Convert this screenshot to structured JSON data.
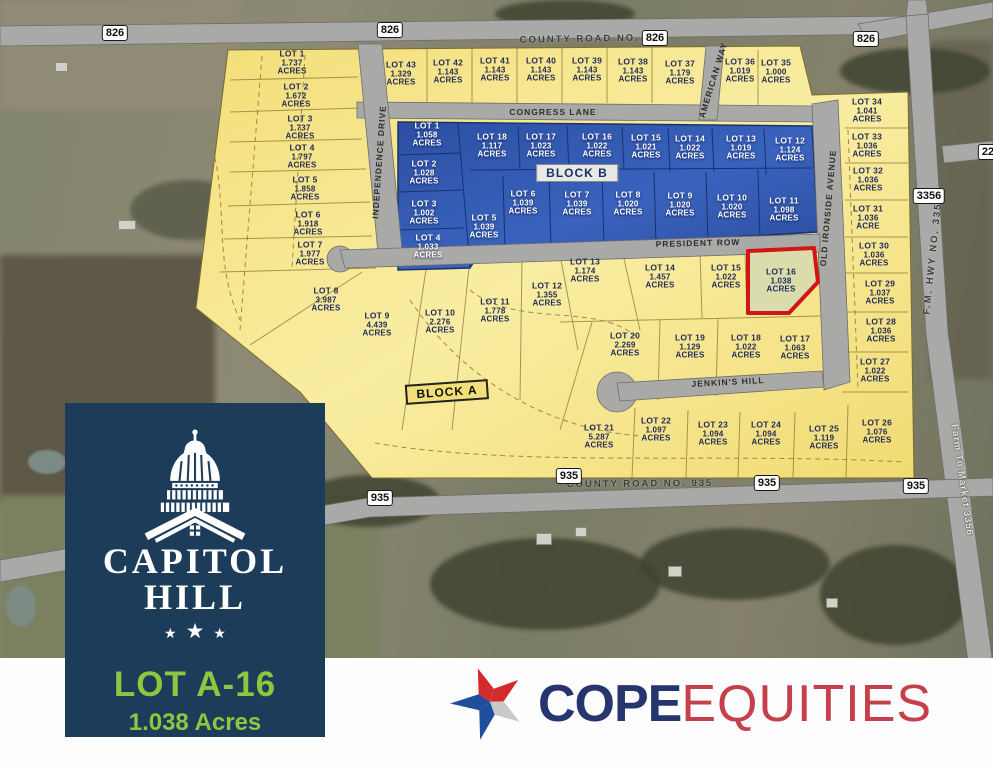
{
  "colors": {
    "lot_yellow": "#f6e488",
    "lot_blue": "#2f55ad",
    "highlight_stroke": "#d01616",
    "panel_navy": "#1d3c59",
    "brand_green": "#8dc63f",
    "cope_navy": "#27356f",
    "cope_red": "#c5404a"
  },
  "branding": {
    "panel": {
      "title_line1": "CAPITOL",
      "title_line2": "HILL",
      "star": "★",
      "lot_id": "LOT A-16",
      "lot_acres": "1.038 Acres"
    },
    "cope": {
      "word1": "COPE",
      "word2": "EQUITIES"
    }
  },
  "map": {
    "blocks": [
      {
        "text": "BLOCK B",
        "x": 577,
        "y": 173,
        "style": "b",
        "rot": 0
      },
      {
        "text": "BLOCK A",
        "x": 447,
        "y": 392,
        "style": "a",
        "rot": -4
      }
    ],
    "street_labels": [
      {
        "text": "COUNTY ROAD NO. 826",
        "x": 593,
        "y": 39,
        "rot": -1,
        "cls": "county"
      },
      {
        "text": "CONGRESS LANE",
        "x": 553,
        "y": 112,
        "rot": 0,
        "cls": "plat"
      },
      {
        "text": "INDEPENDENCE DRIVE",
        "x": 379,
        "y": 162,
        "rot": -86,
        "cls": "plat"
      },
      {
        "text": "AMERICAN WAY",
        "x": 713,
        "y": 80,
        "rot": -73,
        "cls": "plat"
      },
      {
        "text": "OLD IRONSIDE AVENUE",
        "x": 828,
        "y": 208,
        "rot": -85,
        "cls": "plat"
      },
      {
        "text": "PRESIDENT ROW",
        "x": 698,
        "y": 243,
        "rot": -1.5,
        "cls": "plat"
      },
      {
        "text": "JENKIN'S HILL",
        "x": 728,
        "y": 382,
        "rot": -3,
        "cls": "plat"
      },
      {
        "text": "COUNTY ROAD NO. 935",
        "x": 640,
        "y": 484,
        "rot": -0.5,
        "cls": "county"
      },
      {
        "text": "F.M. HWY NO. 3356",
        "x": 933,
        "y": 255,
        "rot": -84,
        "cls": "county"
      },
      {
        "text": "Farm To Market 3356",
        "x": 962,
        "y": 480,
        "rot": 82,
        "cls": "white"
      }
    ],
    "badges": [
      {
        "text": "826",
        "x": 115,
        "y": 33
      },
      {
        "text": "826",
        "x": 390,
        "y": 30
      },
      {
        "text": "826",
        "x": 655,
        "y": 38
      },
      {
        "text": "826",
        "x": 866,
        "y": 39
      },
      {
        "text": "22",
        "x": 988,
        "y": 152
      },
      {
        "text": "3356",
        "x": 929,
        "y": 196
      },
      {
        "text": "935",
        "x": 380,
        "y": 498
      },
      {
        "text": "935",
        "x": 569,
        "y": 476
      },
      {
        "text": "935",
        "x": 767,
        "y": 483
      },
      {
        "text": "935",
        "x": 916,
        "y": 486
      }
    ],
    "lots": [
      {
        "name": "LOT 1",
        "acres": "1.737",
        "unit": "ACRES",
        "x": 292,
        "y": 63,
        "c": "y"
      },
      {
        "name": "LOT 2",
        "acres": "1.672",
        "unit": "ACRES",
        "x": 296,
        "y": 96,
        "c": "y"
      },
      {
        "name": "LOT 3",
        "acres": "1.737",
        "unit": "ACRES",
        "x": 300,
        "y": 128,
        "c": "y"
      },
      {
        "name": "LOT 4",
        "acres": "1.797",
        "unit": "ACRES",
        "x": 302,
        "y": 157,
        "c": "y"
      },
      {
        "name": "LOT 5",
        "acres": "1.858",
        "unit": "ACRES",
        "x": 305,
        "y": 189,
        "c": "y"
      },
      {
        "name": "LOT 6",
        "acres": "1.918",
        "unit": "ACRES",
        "x": 308,
        "y": 224,
        "c": "y"
      },
      {
        "name": "LOT 7",
        "acres": "1.977",
        "unit": "ACRES",
        "x": 310,
        "y": 254,
        "c": "y"
      },
      {
        "name": "LOT 8",
        "acres": "3.987",
        "unit": "ACRES",
        "x": 326,
        "y": 300,
        "c": "y"
      },
      {
        "name": "LOT 9",
        "acres": "4.439",
        "unit": "ACRES",
        "x": 377,
        "y": 325,
        "c": "y"
      },
      {
        "name": "LOT 10",
        "acres": "2.276",
        "unit": "ACRES",
        "x": 440,
        "y": 322,
        "c": "y"
      },
      {
        "name": "LOT 11",
        "acres": "1.778",
        "unit": "ACRES",
        "x": 495,
        "y": 311,
        "c": "y"
      },
      {
        "name": "LOT 12",
        "acres": "1.355",
        "unit": "ACRES",
        "x": 547,
        "y": 295,
        "c": "y"
      },
      {
        "name": "LOT 13",
        "acres": "1.174",
        "unit": "ACRES",
        "x": 585,
        "y": 271,
        "c": "y"
      },
      {
        "name": "LOT 14",
        "acres": "1.457",
        "unit": "ACRES",
        "x": 660,
        "y": 277,
        "c": "y"
      },
      {
        "name": "LOT 15",
        "acres": "1.022",
        "unit": "ACRES",
        "x": 726,
        "y": 277,
        "c": "y"
      },
      {
        "name": "LOT 16",
        "acres": "1.038",
        "unit": "ACRES",
        "x": 781,
        "y": 281,
        "c": "y",
        "hl": true
      },
      {
        "name": "LOT 17",
        "acres": "1.063",
        "unit": "ACRES",
        "x": 795,
        "y": 348,
        "c": "y"
      },
      {
        "name": "LOT 18",
        "acres": "1.022",
        "unit": "ACRES",
        "x": 746,
        "y": 347,
        "c": "y"
      },
      {
        "name": "LOT 19",
        "acres": "1.129",
        "unit": "ACRES",
        "x": 690,
        "y": 347,
        "c": "y"
      },
      {
        "name": "LOT 20",
        "acres": "2.269",
        "unit": "ACRES",
        "x": 625,
        "y": 345,
        "c": "y"
      },
      {
        "name": "LOT 21",
        "acres": "5.287",
        "unit": "ACRES",
        "x": 599,
        "y": 437,
        "c": "y"
      },
      {
        "name": "LOT 22",
        "acres": "1.097",
        "unit": "ACRES",
        "x": 656,
        "y": 430,
        "c": "y"
      },
      {
        "name": "LOT 23",
        "acres": "1.094",
        "unit": "ACRES",
        "x": 713,
        "y": 434,
        "c": "y"
      },
      {
        "name": "LOT 24",
        "acres": "1.094",
        "unit": "ACRES",
        "x": 766,
        "y": 434,
        "c": "y"
      },
      {
        "name": "LOT 25",
        "acres": "1.119",
        "unit": "ACRES",
        "x": 824,
        "y": 438,
        "c": "y"
      },
      {
        "name": "LOT 26",
        "acres": "1.076",
        "unit": "ACRES",
        "x": 877,
        "y": 432,
        "c": "y"
      },
      {
        "name": "LOT 27",
        "acres": "1.022",
        "unit": "ACRES",
        "x": 875,
        "y": 371,
        "c": "y"
      },
      {
        "name": "LOT 28",
        "acres": "1.036",
        "unit": "ACRES",
        "x": 881,
        "y": 331,
        "c": "y"
      },
      {
        "name": "LOT 29",
        "acres": "1.037",
        "unit": "ACRES",
        "x": 880,
        "y": 293,
        "c": "y"
      },
      {
        "name": "LOT 30",
        "acres": "1.036",
        "unit": "ACRES",
        "x": 874,
        "y": 255,
        "c": "y"
      },
      {
        "name": "LOT 31",
        "acres": "1.036",
        "unit": "ACRE",
        "x": 868,
        "y": 218,
        "c": "y"
      },
      {
        "name": "LOT 32",
        "acres": "1.036",
        "unit": "ACRES",
        "x": 868,
        "y": 180,
        "c": "y"
      },
      {
        "name": "LOT 33",
        "acres": "1.036",
        "unit": "ACRES",
        "x": 867,
        "y": 146,
        "c": "y"
      },
      {
        "name": "LOT 34",
        "acres": "1.041",
        "unit": "ACRES",
        "x": 867,
        "y": 111,
        "c": "y"
      },
      {
        "name": "LOT 35",
        "acres": "1.000",
        "unit": "ACRES",
        "x": 776,
        "y": 72,
        "c": "y"
      },
      {
        "name": "LOT 36",
        "acres": "1.019",
        "unit": "ACRES",
        "x": 740,
        "y": 71,
        "c": "y"
      },
      {
        "name": "LOT 37",
        "acres": "1.179",
        "unit": "ACRES",
        "x": 680,
        "y": 73,
        "c": "y"
      },
      {
        "name": "LOT 38",
        "acres": "1.143",
        "unit": "ACRES",
        "x": 633,
        "y": 71,
        "c": "y"
      },
      {
        "name": "LOT 39",
        "acres": "1.143",
        "unit": "ACRES",
        "x": 587,
        "y": 70,
        "c": "y"
      },
      {
        "name": "LOT 40",
        "acres": "1.143",
        "unit": "ACRES",
        "x": 541,
        "y": 70,
        "c": "y"
      },
      {
        "name": "LOT 41",
        "acres": "1.143",
        "unit": "ACRES",
        "x": 495,
        "y": 70,
        "c": "y"
      },
      {
        "name": "LOT 42",
        "acres": "1.143",
        "unit": "ACRES",
        "x": 448,
        "y": 72,
        "c": "y"
      },
      {
        "name": "LOT 43",
        "acres": "1.329",
        "unit": "ACRES",
        "x": 401,
        "y": 74,
        "c": "y"
      },
      {
        "name": "LOT 1",
        "acres": "1.058",
        "unit": "ACRES",
        "x": 427,
        "y": 135,
        "c": "b"
      },
      {
        "name": "LOT 2",
        "acres": "1.028",
        "unit": "ACRES",
        "x": 424,
        "y": 173,
        "c": "b"
      },
      {
        "name": "LOT 3",
        "acres": "1.002",
        "unit": "ACRES",
        "x": 424,
        "y": 213,
        "c": "b"
      },
      {
        "name": "LOT 4",
        "acres": "1.033",
        "unit": "ACRES",
        "x": 428,
        "y": 247,
        "c": "b"
      },
      {
        "name": "LOT 5",
        "acres": "1.039",
        "unit": "ACRES",
        "x": 484,
        "y": 227,
        "c": "b"
      },
      {
        "name": "LOT 6",
        "acres": "1.039",
        "unit": "ACRES",
        "x": 523,
        "y": 203,
        "c": "b"
      },
      {
        "name": "LOT 7",
        "acres": "1.039",
        "unit": "ACRES",
        "x": 577,
        "y": 204,
        "c": "b"
      },
      {
        "name": "LOT 8",
        "acres": "1.020",
        "unit": "ACRES",
        "x": 628,
        "y": 204,
        "c": "b"
      },
      {
        "name": "LOT 9",
        "acres": "1.020",
        "unit": "ACRES",
        "x": 680,
        "y": 205,
        "c": "b"
      },
      {
        "name": "LOT 10",
        "acres": "1.020",
        "unit": "ACRES",
        "x": 732,
        "y": 207,
        "c": "b"
      },
      {
        "name": "LOT 11",
        "acres": "1.098",
        "unit": "ACRES",
        "x": 784,
        "y": 210,
        "c": "b"
      },
      {
        "name": "LOT 12",
        "acres": "1.124",
        "unit": "ACRES",
        "x": 790,
        "y": 150,
        "c": "b"
      },
      {
        "name": "LOT 13",
        "acres": "1.019",
        "unit": "ACRES",
        "x": 741,
        "y": 148,
        "c": "b"
      },
      {
        "name": "LOT 14",
        "acres": "1.022",
        "unit": "ACRES",
        "x": 690,
        "y": 148,
        "c": "b"
      },
      {
        "name": "LOT 15",
        "acres": "1.021",
        "unit": "ACRES",
        "x": 646,
        "y": 147,
        "c": "b"
      },
      {
        "name": "LOT 16",
        "acres": "1.022",
        "unit": "ACRES",
        "x": 597,
        "y": 146,
        "c": "b"
      },
      {
        "name": "LOT 17",
        "acres": "1.023",
        "unit": "ACRES",
        "x": 541,
        "y": 146,
        "c": "b"
      },
      {
        "name": "LOT 18",
        "acres": "1.117",
        "unit": "ACRES",
        "x": 492,
        "y": 146,
        "c": "b"
      }
    ]
  }
}
